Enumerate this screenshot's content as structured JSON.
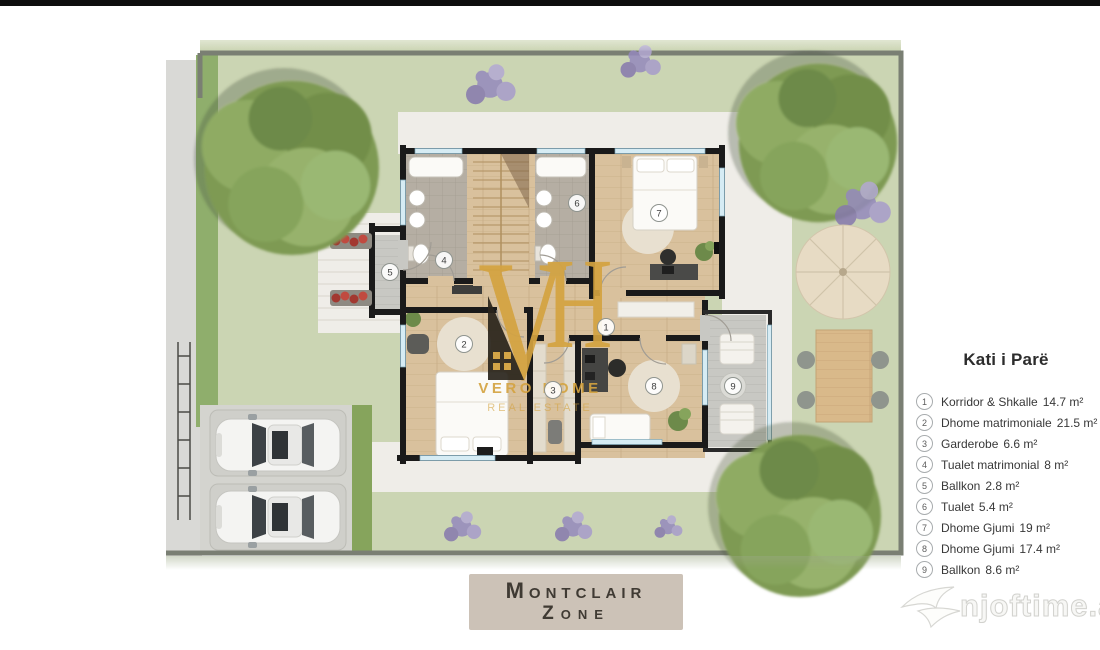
{
  "plan": {
    "room_numbers": [
      "1",
      "2",
      "3",
      "4",
      "5",
      "6",
      "7",
      "8",
      "9"
    ]
  },
  "legend": {
    "title": "Kati i Parë",
    "items": [
      {
        "num": "1",
        "label": "Korridor & Shkalle",
        "area": "14.7 m²"
      },
      {
        "num": "2",
        "label": "Dhome matrimoniale",
        "area": "21.5 m²"
      },
      {
        "num": "3",
        "label": "Garderobe",
        "area": "6.6 m²"
      },
      {
        "num": "4",
        "label": "Tualet matrimonial",
        "area": "8 m²"
      },
      {
        "num": "5",
        "label": "Ballkon",
        "area": "2.8 m²"
      },
      {
        "num": "6",
        "label": "Tualet",
        "area": "5.4 m²"
      },
      {
        "num": "7",
        "label": "Dhome Gjumi",
        "area": "19 m²"
      },
      {
        "num": "8",
        "label": "Dhome Gjumi",
        "area": "17.4 m²"
      },
      {
        "num": "9",
        "label": "Ballkon",
        "area": "8.6 m²"
      }
    ]
  },
  "zone_label": {
    "line1": "Montclair",
    "line2": "Zone"
  },
  "logo": {
    "monogram_left": "V",
    "monogram_right": "H",
    "name": "VERO HOME",
    "tagline": "REAL ESTATE"
  },
  "watermark": {
    "text": "njoftime.al"
  },
  "colors": {
    "logo_gold": "#d4a340",
    "zone_box_bg": "#ccc2b7",
    "grass": "#cbd5b3",
    "wall_black": "#1a1a1a",
    "window_blue": "#d6ecf4",
    "wood_floor": "#d9c19d",
    "tile_floor": "#b5aea3",
    "plan_border": "#7a7f73"
  }
}
